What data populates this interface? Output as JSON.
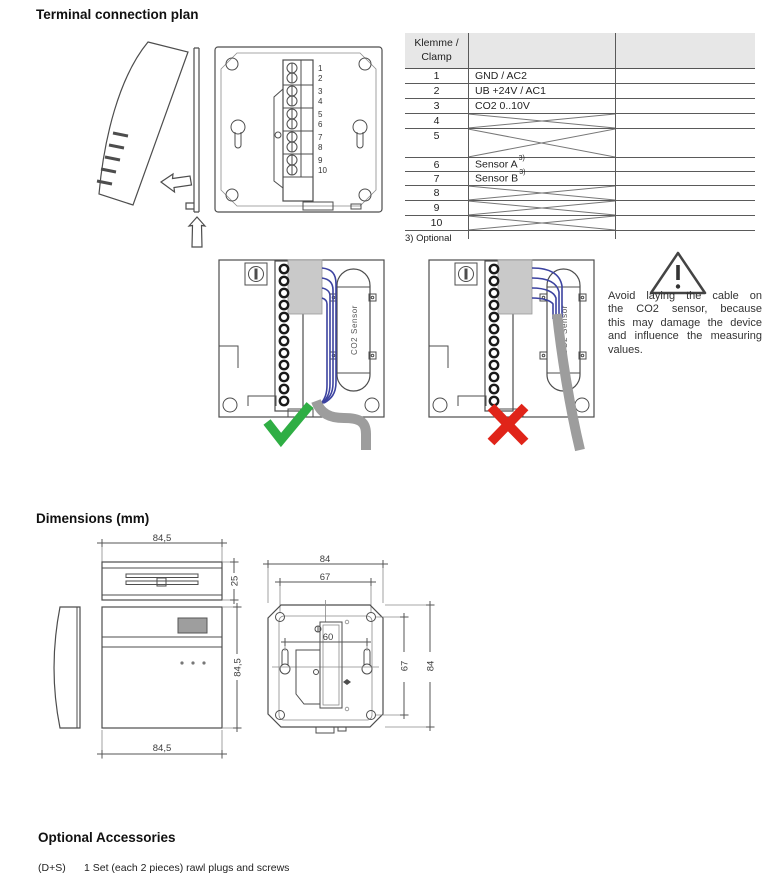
{
  "headings": {
    "terminal_plan": "Terminal connection plan",
    "dimensions": "Dimensions (mm)",
    "accessories": "Optional Accessories"
  },
  "terminal_table": {
    "header_line1": "Klemme /",
    "header_line2": "Clamp",
    "rows": [
      {
        "num": "1",
        "label": "GND / AC2",
        "crossed": false
      },
      {
        "num": "2",
        "label": "UB +24V / AC1",
        "crossed": false
      },
      {
        "num": "3",
        "label": "CO2 0..10V",
        "crossed": false
      },
      {
        "num": "4",
        "label": "",
        "crossed": true
      },
      {
        "num": "5",
        "label": "",
        "crossed": true
      },
      {
        "num": "6",
        "label": "Sensor A",
        "footnote_ref": "3)",
        "crossed": false
      },
      {
        "num": "7",
        "label": "Sensor B",
        "footnote_ref": "3)",
        "crossed": false
      },
      {
        "num": "8",
        "label": "",
        "crossed": true
      },
      {
        "num": "9",
        "label": "",
        "crossed": true
      },
      {
        "num": "10",
        "label": "",
        "crossed": true
      }
    ],
    "footnote": "3) Optional"
  },
  "device_diagram": {
    "terminal_numbers": [
      "1",
      "2",
      "3",
      "4",
      "5",
      "6",
      "7",
      "8",
      "9",
      "10"
    ]
  },
  "wiring_diagrams": {
    "sensor_label": "CO2 Sensor",
    "correct_icon": "green-check",
    "incorrect_icon": "red-cross"
  },
  "warning": {
    "icon": "warning-triangle",
    "lines": [
      "Avoid laying the cable on",
      "the CO2 sensor, because",
      "this may damage the device",
      "and influence the measuring",
      "values."
    ]
  },
  "dimension_labels": {
    "top_width": "84,5",
    "top_depth": "25",
    "front_height": "84,5",
    "front_width": "84,5",
    "back_outer_width": "84",
    "back_hole_width": "67",
    "back_keyhole_width": "60",
    "back_hole_height": "67",
    "back_outer_height": "84"
  },
  "accessories": {
    "code": "(D+S)",
    "text": "1 Set (each 2 pieces) rawl plugs and screws"
  },
  "colors": {
    "check_green": "#2fae44",
    "cross_red": "#e02419",
    "wire_blue": "#3c43a0",
    "cable_gray": "#9d9d9d",
    "table_header_gray": "#e7e7e7"
  }
}
